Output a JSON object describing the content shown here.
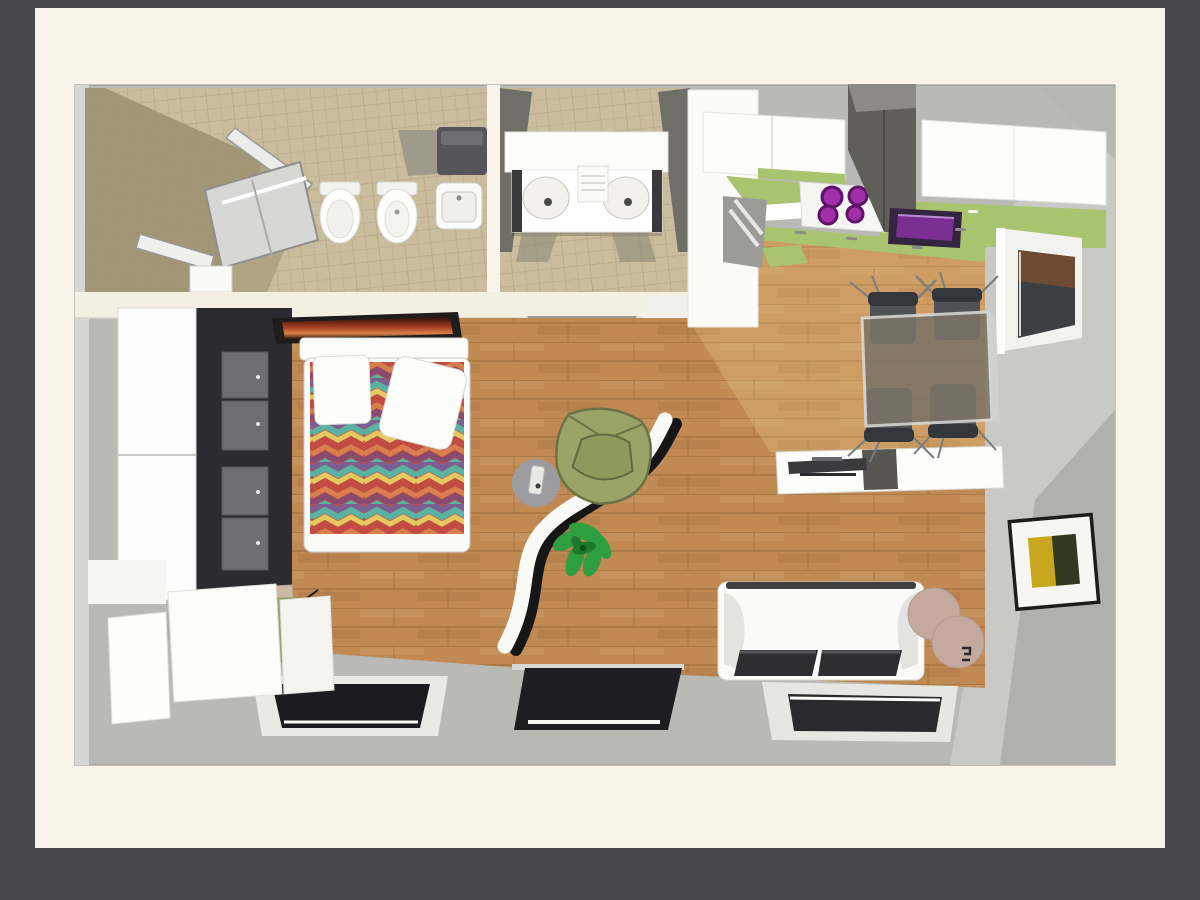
{
  "scene": {
    "type": "3d-floor-plan-top-view",
    "description": "Top-down 3D architectural render of a studio apartment on a cream mat over a dark gray background",
    "visible_text": ""
  },
  "palette": {
    "bgDark": "#46464b",
    "page": "#f8f4e9",
    "wallFace": "#c9c9c5",
    "wallShadow": "#b0b0ac",
    "floorGray": "#b9bab6",
    "wood": "#c18a52",
    "woodLine": "#9e6f3e",
    "tile": "#c9bd9e",
    "tileShadow": "#9d9272",
    "counterGreen": "#a8c46e",
    "accentPurple": "#7c2f92",
    "purpleDark": "#33243f",
    "hoodGray": "#5f5f58",
    "wardrobeDark": "#2c2c30",
    "doorGray": "#6e6e72",
    "olive": "#9aa466",
    "plant": "#2f9e3e",
    "cushion": "#2e2e31",
    "pouf": "#c4aa9e",
    "glassTable": "#7b7468",
    "chairGray": "#4e5256",
    "artYellow": "#c8a61e",
    "artGreen": "#33391f",
    "duvetStripes": [
      "#7b5f93",
      "#58b3a3",
      "#e5c95e",
      "#c24c41",
      "#d97f4e",
      "#8a4a6e"
    ]
  },
  "rooms": {
    "bathroom_main": {
      "items": [
        "corner-shower-enclosure",
        "toilet",
        "bidet",
        "wall-basin",
        "washing-machine",
        "tiled-floor"
      ]
    },
    "shower_room": {
      "items": [
        "double-basin-vanity",
        "tiled-floor",
        "door-opening"
      ]
    },
    "kitchen": {
      "items": [
        "upper-cabinets",
        "extractor-hood",
        "hob-4-purple-burners",
        "purple-sink",
        "green-worktop",
        "tall-white-cabinet",
        "window",
        "green-floor-mat"
      ]
    },
    "bedroom": {
      "items": [
        "wardrobe",
        "double-bed",
        "chevron-duvet",
        "pillow",
        "tilted-pillow",
        "headboard",
        "sunset-artwork",
        "desk",
        "computer",
        "desk-chair"
      ]
    },
    "living_area": {
      "items": [
        "olive-armchair",
        "round-side-table",
        "s-curve-divider",
        "potted-plant",
        "white-sofa",
        "seat-cushions",
        "tv-sideboard",
        "flat-tv",
        "glass-dining-table",
        "dining-chairs-x4",
        "pouf-pair",
        "framed-picture"
      ]
    },
    "exterior_band": {
      "items": [
        "left-window",
        "center-glass-panel",
        "right-window",
        "leaning-door-panels"
      ]
    }
  }
}
